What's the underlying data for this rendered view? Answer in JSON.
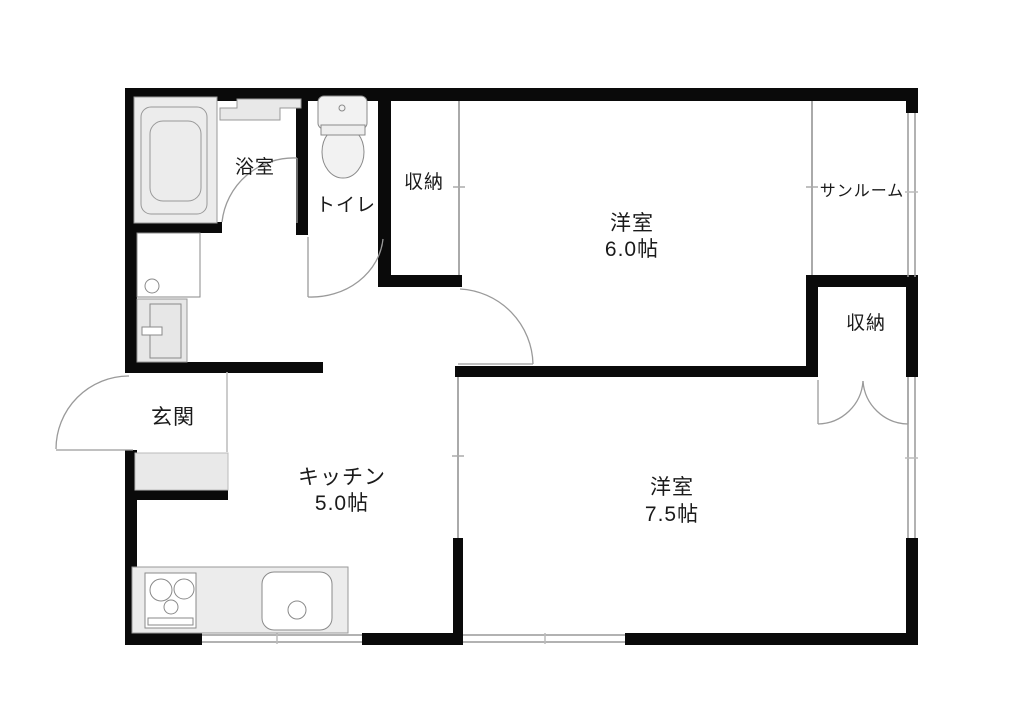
{
  "plan": {
    "type": "floor-plan",
    "labels": {
      "bathroom": "浴室",
      "toilet": "トイレ",
      "closet_hall": "収納",
      "bedroom6": {
        "name": "洋室",
        "size": "6.0帖"
      },
      "sunroom": "サンルーム",
      "closet_bedroom": "収納",
      "entrance": "玄関",
      "kitchen": {
        "name": "キッチン",
        "size": "5.0帖"
      },
      "bedroom75": {
        "name": "洋室",
        "size": "7.5帖"
      }
    },
    "palette": {
      "wall": "#0a0a0a",
      "fixture_outline": "#8a8a8a",
      "fixture_fill": "#ececec",
      "fixture_fill_light": "#f2f2f2",
      "door_line": "#9a9a9a",
      "partition_line": "#aaaaaa",
      "window_line": "#999999",
      "text": "#1a1a1a",
      "background": "#ffffff"
    },
    "fixtures": [
      "bathtub",
      "vanity-counter",
      "toilet-fixture",
      "washing-machine",
      "water-heater",
      "entrance-step",
      "gas-stove",
      "kitchen-sink"
    ]
  }
}
